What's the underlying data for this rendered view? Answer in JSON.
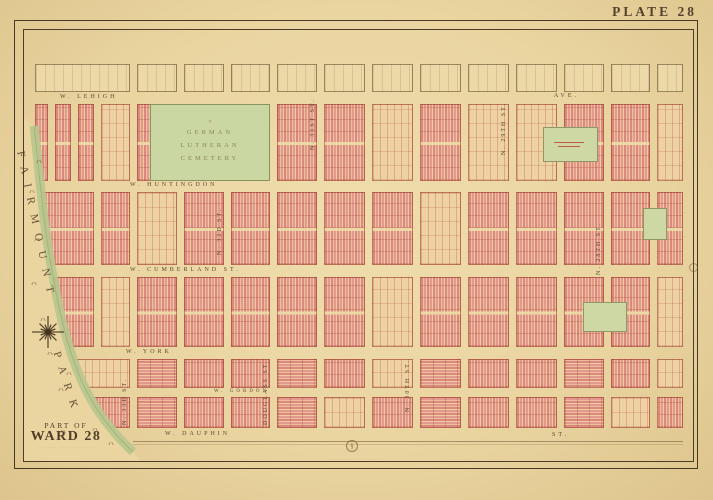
{
  "page": {
    "plate_title": "PLATE 28"
  },
  "ward_label": {
    "line1": "PART OF",
    "line2": "WARD 28",
    "caption": "·· ····· ··· ···· ·····"
  },
  "park": {
    "word1": "FAIRMOUNT",
    "word2": "PARK"
  },
  "cemetery": {
    "marker": "†",
    "line1": "GERMAN",
    "line2": "LUTHERAN",
    "line3": "CEMETERY"
  },
  "streets": {
    "horizontal": {
      "lehigh": {
        "name": "W. LEHIGH",
        "suffix": "AVE."
      },
      "huntingdon": {
        "name": "W. HUNTINGDON"
      },
      "cumberland": {
        "name": "W. CUMBERLAND ST."
      },
      "york": {
        "name": "W. YORK"
      },
      "gordon": {
        "name": "W. GORDON"
      },
      "dauphin": {
        "name": "W. DAUPHIN",
        "suffix": "ST."
      }
    },
    "vertical": {
      "s33": "N. 33D ST.",
      "s32": "N. 32D ST.",
      "s31": "N. 31ST ST.",
      "s30": "N. 30TH ST.",
      "s29": "N. 29TH ST.",
      "s28": "N. 28TH ST.",
      "douglass": "DOUGLASS ST."
    }
  },
  "ornaments": {
    "medallion_glyph": "§"
  },
  "colors": {
    "paper": "#ead5a1",
    "building_pink": "#e0968c",
    "lot_line_red": "#a43c2d",
    "green_area": "#cbd7a2",
    "park_band": "#b7c78e",
    "ink": "#54412c"
  }
}
